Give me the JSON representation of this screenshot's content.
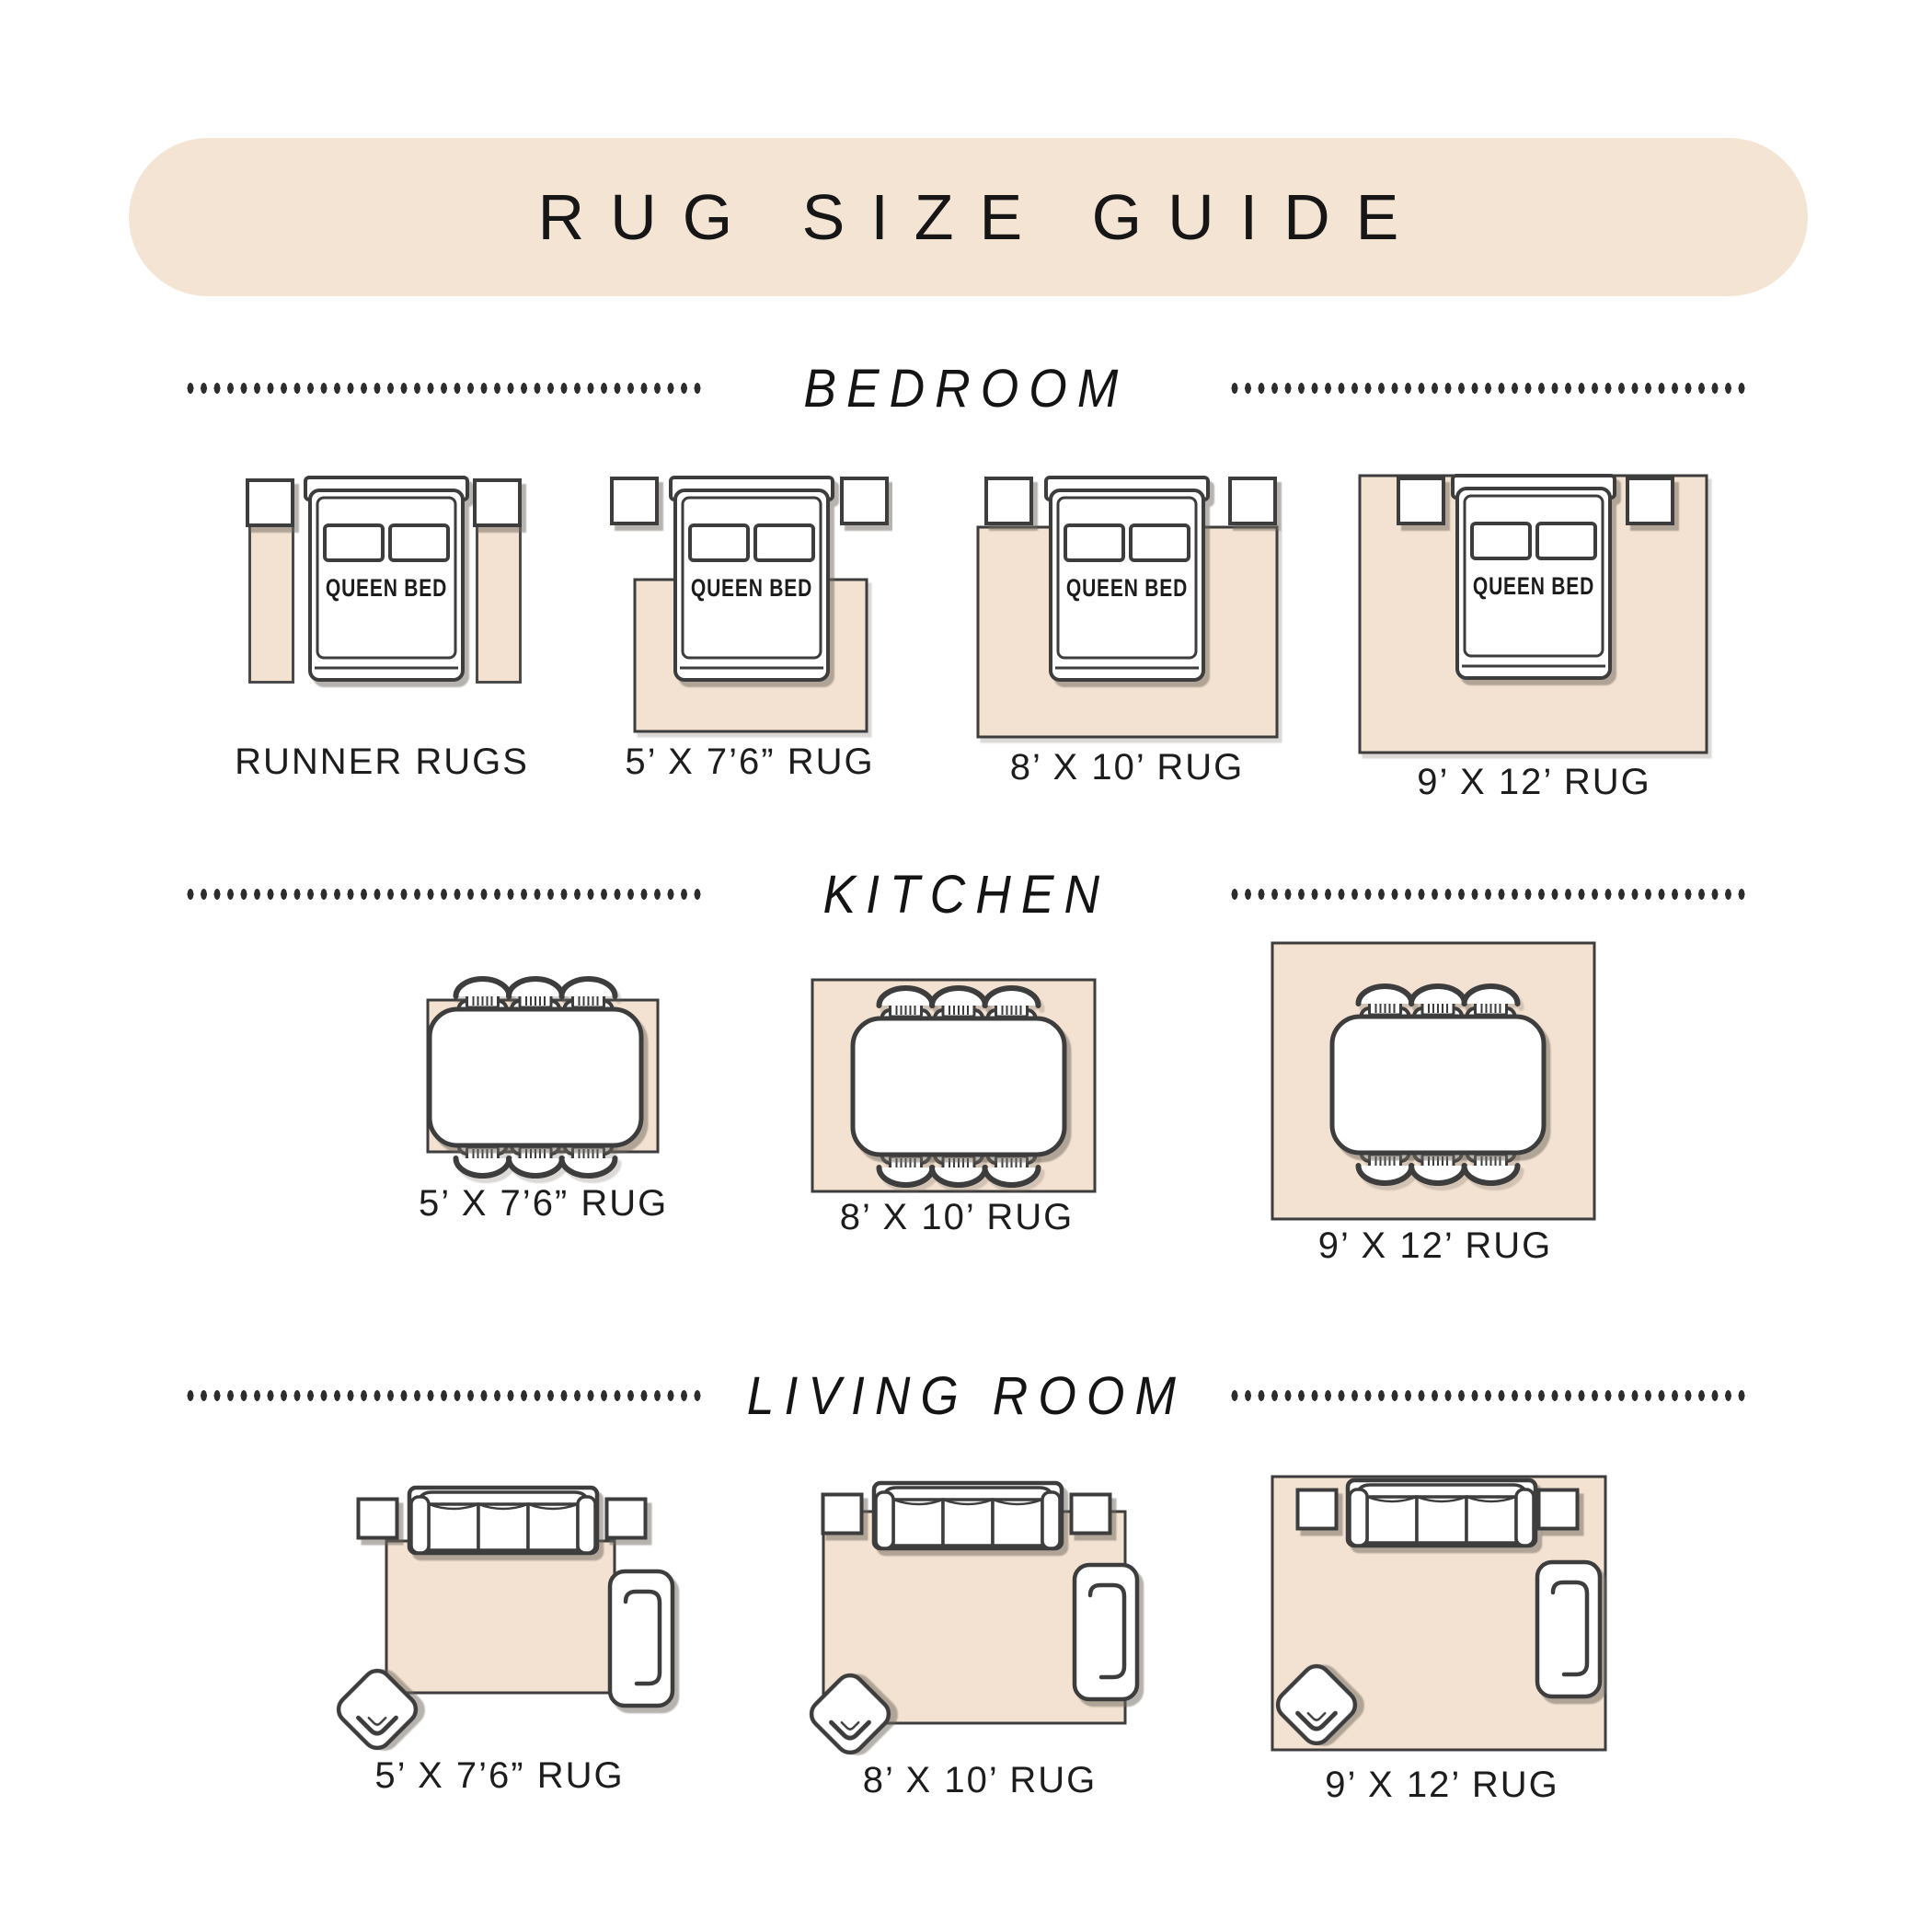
{
  "title": "RUG SIZE GUIDE",
  "bed_label": "QUEEN BED",
  "colors": {
    "banner_bg": "#f4e4d4",
    "rug_fill": "#f3e2d1",
    "outline": "#3d3d3d",
    "text_dark": "#1a1a1a"
  },
  "sections": {
    "bedroom": {
      "heading": "BEDROOM",
      "items": [
        {
          "label": "RUNNER RUGS"
        },
        {
          "label": "5’ X 7’6” RUG"
        },
        {
          "label": "8’ X 10’ RUG"
        },
        {
          "label": "9’ X 12’ RUG"
        }
      ]
    },
    "kitchen": {
      "heading": "KITCHEN",
      "items": [
        {
          "label": "5’ X 7’6” RUG"
        },
        {
          "label": "8’ X 10’ RUG"
        },
        {
          "label": "9’ X 12’ RUG"
        }
      ]
    },
    "living_room": {
      "heading": "LIVING ROOM",
      "items": [
        {
          "label": "5’ X 7’6” RUG"
        },
        {
          "label": "8’ X 10’ RUG"
        },
        {
          "label": "9’ X 12’ RUG"
        }
      ]
    }
  }
}
